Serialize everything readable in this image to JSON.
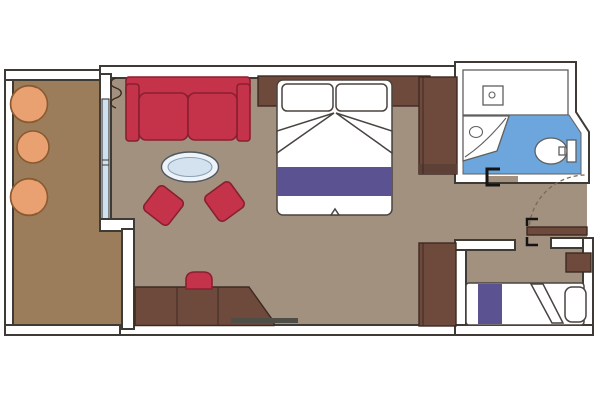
{
  "plan": {
    "type": "cruise-cabin-floor-plan",
    "rooms": [
      {
        "name": "balcony",
        "items": [
          "armchair",
          "round-table",
          "armchair"
        ]
      },
      {
        "name": "living-area",
        "items": [
          "sofa",
          "oval-coffee-table",
          "ottoman",
          "ottoman",
          "curtain",
          "sliding-glass-door",
          "desk-cabinet",
          "stool",
          "wall-shelf",
          "storage-unit"
        ]
      },
      {
        "name": "bedroom",
        "items": [
          "double-bed",
          "pillow",
          "pillow",
          "folded-sheet",
          "bed-runner",
          "headboard",
          "wardrobe"
        ]
      },
      {
        "name": "bathroom",
        "items": [
          "vanity-counter",
          "sink",
          "corner-shower",
          "toilet",
          "door-track"
        ]
      },
      {
        "name": "hallway",
        "items": [
          "entrance-door-leaf",
          "door-swing-arc",
          "door-hinge-marks"
        ]
      },
      {
        "name": "second-sleeping-area",
        "items": [
          "sofa-bed",
          "bed-runner",
          "pillow",
          "folded-blanket",
          "side-table"
        ]
      }
    ]
  },
  "colors": {
    "background": "#ffffff",
    "wall_fill": "#ffffff",
    "wall_outline": "#3e3a36",
    "floor_balcony": "#9b7d5c",
    "floor_main": "#a39180",
    "floor_bathroom": "#6ca6dc",
    "glass_blue": "#cfe1ef",
    "furniture_red": "#c43349",
    "furniture_red_outline": "#8a1f30",
    "furniture_brown": "#6e4a3d",
    "furniture_brown_outline": "#3e2a22",
    "furniture_brown_shade": "#5d4136",
    "furniture_orange": "#e9a171",
    "furniture_orange_outline": "#8a5a30",
    "textile_purple": "#5b5292",
    "bedding_outline": "#4a4440",
    "fixture_outline": "#5f5f5f",
    "door_symbol": "#141414",
    "door_arc": "#7a6a55",
    "shelf_line": "#4e4e46",
    "curtain": "#3a2a1a",
    "closet_tan": "#b2a083",
    "table_glass": "#edf3f8",
    "table_outline": "#4e5860",
    "table_glass_inner": "#d3e2ee",
    "table_inner_outline": "#8aa2b8"
  }
}
